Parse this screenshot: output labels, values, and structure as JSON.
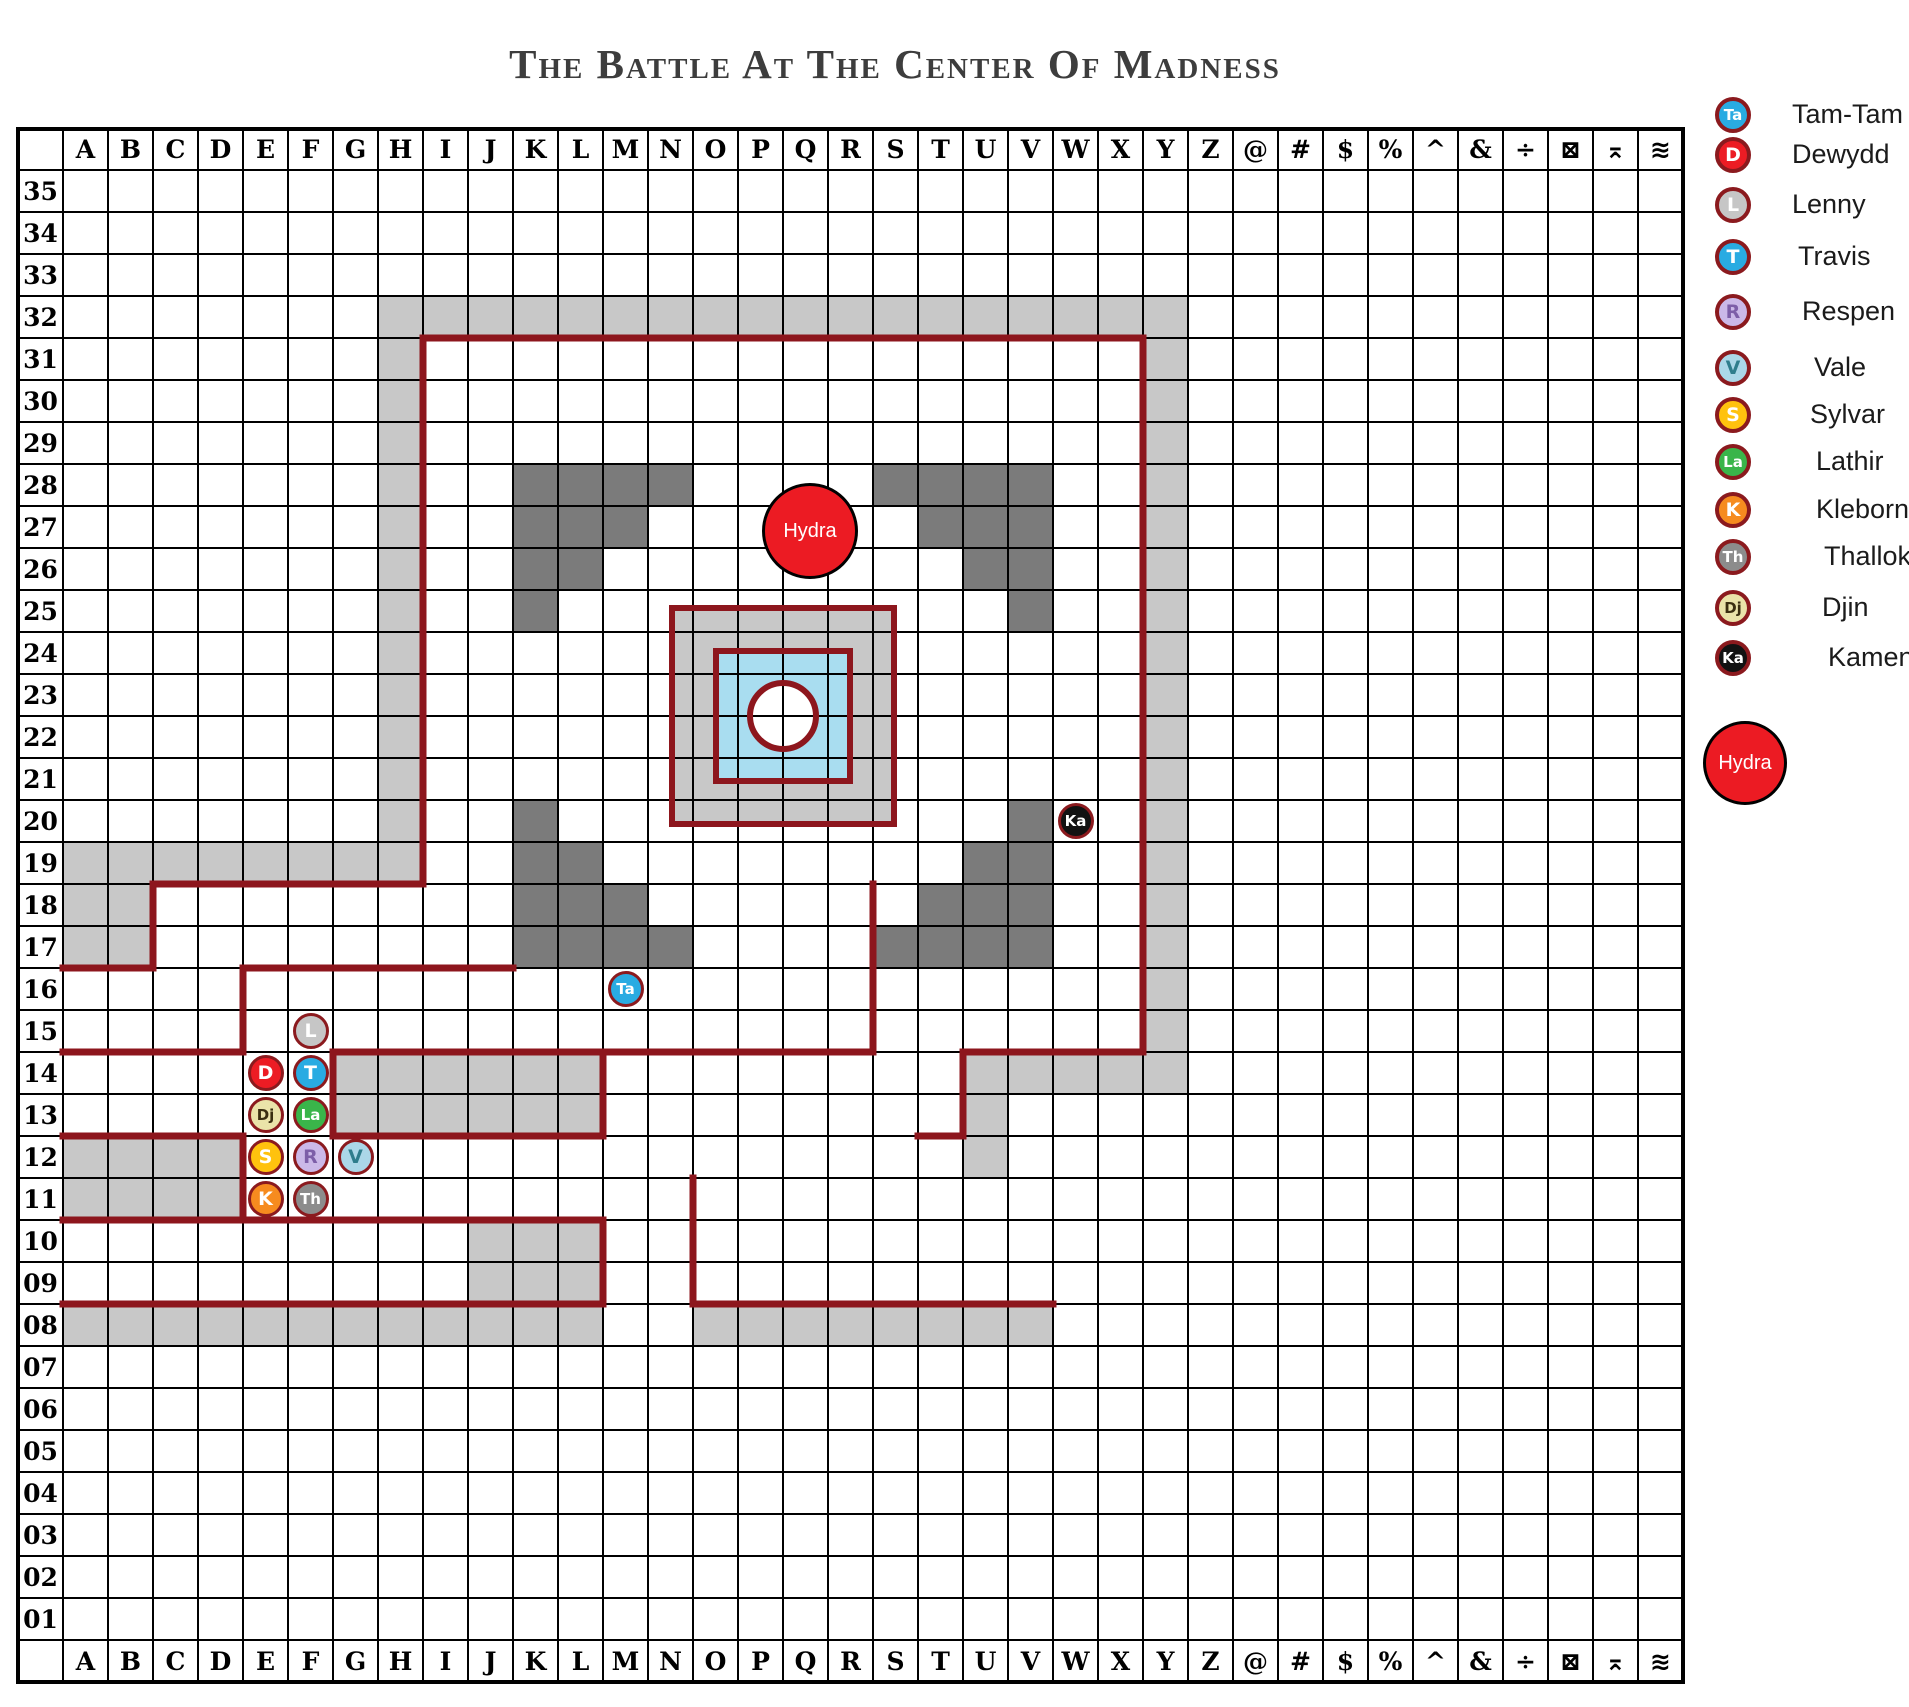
{
  "title": "The Battle At The Center Of Madness",
  "grid": {
    "columns": [
      "A",
      "B",
      "C",
      "D",
      "E",
      "F",
      "G",
      "H",
      "I",
      "J",
      "K",
      "L",
      "M",
      "N",
      "O",
      "P",
      "Q",
      "R",
      "S",
      "T",
      "U",
      "V",
      "W",
      "X",
      "Y",
      "Z",
      "@",
      "#",
      "$",
      "%",
      "^",
      "&",
      "÷",
      "⊠",
      "⌅",
      "≋"
    ],
    "rows": [
      "35",
      "34",
      "33",
      "32",
      "31",
      "30",
      "29",
      "28",
      "27",
      "26",
      "25",
      "24",
      "23",
      "22",
      "21",
      "20",
      "19",
      "18",
      "17",
      "16",
      "15",
      "14",
      "13",
      "12",
      "11",
      "10",
      "09",
      "08",
      "07",
      "06",
      "05",
      "04",
      "03",
      "02",
      "01"
    ]
  },
  "colors": {
    "wall": "#8D161D",
    "light_gray": "#C8C8C8",
    "dark_gray": "#7B7B7B",
    "pool_blue": "#A9DDF0",
    "grid_line": "#000000",
    "hydra_red": "#EC1B23",
    "token_ring": "#8B1A1E"
  },
  "map": {
    "light_cells": "H32 I32 J32 K32 L32 M32 N32 O32 P32 Q32 R32 S32 T32 U32 V32 W32 X32 Y32 H31 H30 H29 H28 H27 H26 H25 H24 H23 H22 H21 H20 Y31 Y30 Y29 Y28 Y27 Y26 Y25 Y24 Y23 Y22 Y21 Y20 Y19 Y18 Y17 Y16 Y15 Y14 A19 B19 C19 D19 E19 F19 G19 H19 A18 B18 A17 B17 G14 H14 I14 J14 K14 L14 G13 H13 I13 J13 K13 L13 A12 B12 C12 D12 A11 B11 C11 D11 J10 K10 L10 J09 K09 L09 A08 B08 C08 D08 E08 F08 G08 H08 I08 J08 K08 L08 O08 P08 Q08 R08 S08 T08 U08 V08 U14 V14 W14 X14 U13 U12",
    "dark_cells": "K28 L28 M28 N28 K27 L27 M27 K26 L26 K25 S28 T28 U28 V28 T27 U27 V27 U26 V26 V25 K20 K19 L19 K18 L18 M18 K17 L17 M17 N17 V20 U19 V19 T18 U18 V18 S17 T17 U17 V17",
    "walls": [
      [
        423,
        338,
        1143,
        338
      ],
      [
        423,
        338,
        423,
        884
      ],
      [
        1143,
        338,
        1143,
        1052
      ],
      [
        153,
        884,
        423,
        884
      ],
      [
        153,
        884,
        153,
        968
      ],
      [
        63,
        968,
        153,
        968
      ],
      [
        243,
        968,
        513,
        968
      ],
      [
        243,
        968,
        243,
        1052
      ],
      [
        63,
        1052,
        243,
        1052
      ],
      [
        333,
        1052,
        873,
        1052
      ],
      [
        873,
        884,
        873,
        1052
      ],
      [
        333,
        1052,
        333,
        1136
      ],
      [
        603,
        1052,
        603,
        1136
      ],
      [
        333,
        1136,
        603,
        1136
      ],
      [
        63,
        1136,
        243,
        1136
      ],
      [
        243,
        1136,
        243,
        1220
      ],
      [
        63,
        1220,
        603,
        1220
      ],
      [
        603,
        1220,
        603,
        1304
      ],
      [
        63,
        1304,
        603,
        1304
      ],
      [
        693,
        1304,
        1053,
        1304
      ],
      [
        693,
        1178,
        693,
        1304
      ],
      [
        963,
        1052,
        1143,
        1052
      ],
      [
        963,
        1052,
        963,
        1136
      ],
      [
        918,
        1136,
        963,
        1136
      ]
    ],
    "structure": {
      "outer": [
        672,
        608,
        222,
        216
      ],
      "inner": [
        716,
        651,
        134,
        130
      ],
      "circle": [
        783,
        716,
        33
      ]
    },
    "tokens": [
      {
        "id": "lenny",
        "cell": "F15"
      },
      {
        "id": "dewydd",
        "cell": "E14"
      },
      {
        "id": "travis",
        "cell": "F14"
      },
      {
        "id": "djin",
        "cell": "E13"
      },
      {
        "id": "lathir",
        "cell": "F13"
      },
      {
        "id": "sylvar",
        "cell": "E12"
      },
      {
        "id": "respen",
        "cell": "F12"
      },
      {
        "id": "vale",
        "cell": "G12"
      },
      {
        "id": "kleborn",
        "cell": "E11"
      },
      {
        "id": "thallok",
        "cell": "F11"
      },
      {
        "id": "tam_tam",
        "cell": "M16"
      },
      {
        "id": "kamen",
        "cell": "W20"
      }
    ],
    "hydra_token": {
      "label": "Hydra",
      "x": 810,
      "y": 531,
      "d": 96
    }
  },
  "legend": {
    "entries": [
      {
        "id": "tam_tam",
        "initials": "Ta",
        "label": "Tam-Tam",
        "fill": "#29ABE2",
        "fg": "#FFFFFF",
        "y": 115,
        "dx": 0
      },
      {
        "id": "dewydd",
        "initials": "D",
        "label": "Dewydd",
        "fill": "#EC1C24",
        "fg": "#FFFFFF",
        "y": 155,
        "dx": 0
      },
      {
        "id": "lenny",
        "initials": "L",
        "label": "Lenny",
        "fill": "#C6C6C6",
        "fg": "#FFFFFF",
        "y": 205,
        "dx": 0
      },
      {
        "id": "travis",
        "initials": "T",
        "label": "Travis",
        "fill": "#29ABE2",
        "fg": "#FFFFFF",
        "y": 257,
        "dx": 6
      },
      {
        "id": "respen",
        "initials": "R",
        "label": "Respen",
        "fill": "#CBB8E8",
        "fg": "#7D5EA8",
        "y": 312,
        "dx": 10
      },
      {
        "id": "vale",
        "initials": "V",
        "label": "Vale",
        "fill": "#ABD7E8",
        "fg": "#2E7D8C",
        "y": 368,
        "dx": 22
      },
      {
        "id": "sylvar",
        "initials": "S",
        "label": "Sylvar",
        "fill": "#FFC20E",
        "fg": "#FFFFFF",
        "y": 415,
        "dx": 18
      },
      {
        "id": "lathir",
        "initials": "La",
        "label": "Lathir",
        "fill": "#3AB54A",
        "fg": "#FFFFFF",
        "y": 462,
        "dx": 24
      },
      {
        "id": "kleborn",
        "initials": "K",
        "label": "Kleborn",
        "fill": "#F68B1F",
        "fg": "#FFFFFF",
        "y": 510,
        "dx": 24
      },
      {
        "id": "thallok",
        "initials": "Th",
        "label": "Thallok",
        "fill": "#8C8C8C",
        "fg": "#FFFFFF",
        "y": 557,
        "dx": 32
      },
      {
        "id": "djin",
        "initials": "Dj",
        "label": "Djin",
        "fill": "#EAE3A9",
        "fg": "#3A2E10",
        "y": 608,
        "dx": 30
      },
      {
        "id": "kamen",
        "initials": "Ka",
        "label": "Kamen",
        "fill": "#121212",
        "fg": "#FFFFFF",
        "y": 658,
        "dx": 36
      }
    ],
    "hydra": {
      "label": "Hydra",
      "x": 1745,
      "y": 763,
      "d": 84
    }
  }
}
